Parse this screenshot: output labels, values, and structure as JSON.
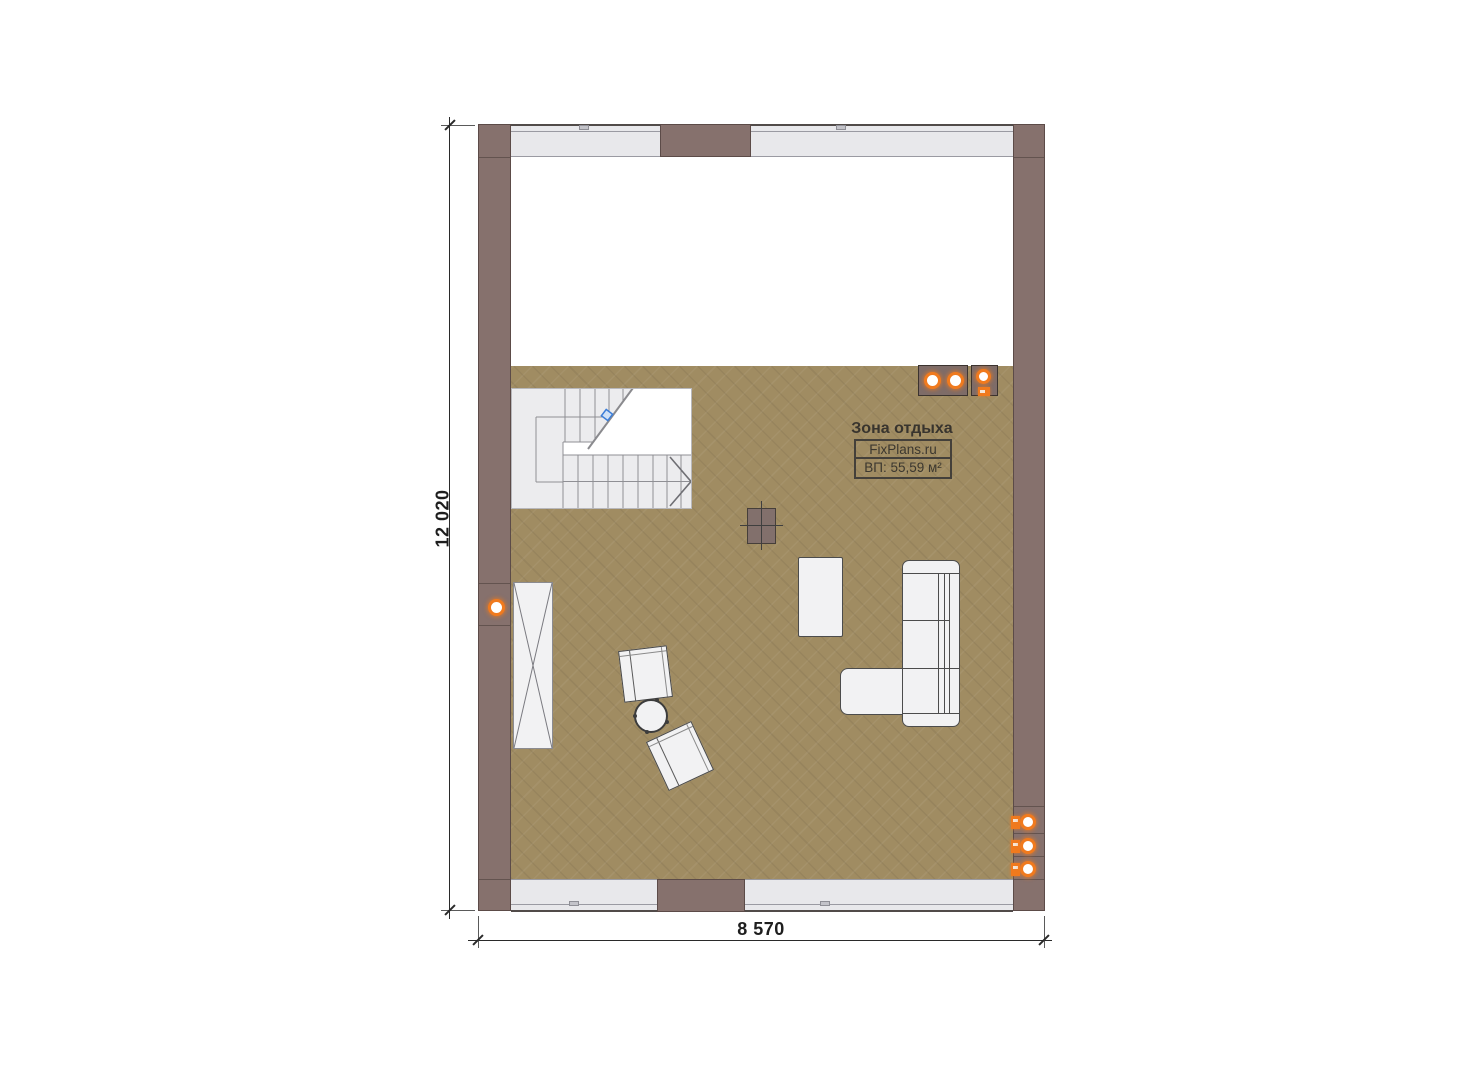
{
  "plan": {
    "zone_label": "Зона отдыха",
    "brand": "FixPlans.ru",
    "area_label": "ВП: 55,59 м²"
  },
  "dimensions": {
    "width_label": "8 570",
    "height_label": "12 020"
  },
  "objects": {
    "staircase": "u-shaped-stair-with-break-line",
    "wardrobe": "tall-cabinet-x-cross",
    "sofa": "l-shaped-sofa",
    "coffee_table": "rectangular-table",
    "armchairs": 2,
    "side_table": "round-table",
    "column": "square-column-with-axis-cross",
    "ceiling_lights_top_right": 3,
    "wall_lights_right": 3,
    "wall_lights_left": 1
  },
  "colors": {
    "wall": "#86716d",
    "floor": "#a08c62",
    "glass": "#e8e8eb",
    "accent_orange": "#f07a1e",
    "handle_blue": "#3b7dd8",
    "stair_bg": "#ececee"
  }
}
